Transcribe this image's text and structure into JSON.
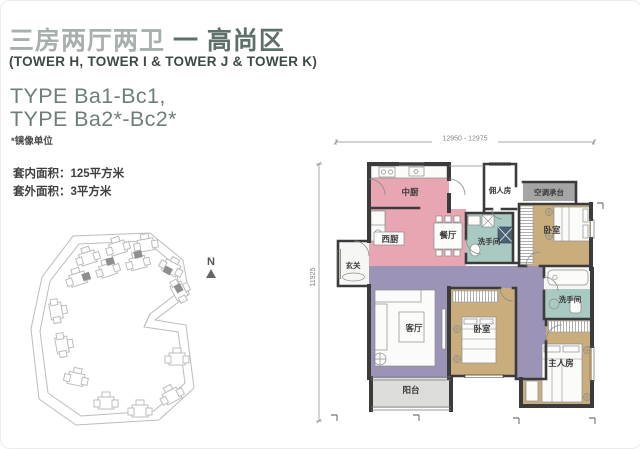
{
  "header": {
    "title_light": "三房两厅两卫",
    "title_bold": "一 高尚区",
    "towers": "(TOWER H, TOWER I & TOWER J & TOWER K)",
    "type_line1": "TYPE Ba1-Bc1,",
    "type_line2": "TYPE Ba2*-Bc2*",
    "mirror_note": "*镜像单位"
  },
  "areas": {
    "inner_area": "套内面积：125平方米",
    "outer_area": "套外面积：3平方米"
  },
  "site_plan": {
    "north_label": "N"
  },
  "floor_plan": {
    "dim_top": "12950 - 12975",
    "dim_left": "11925",
    "rooms": [
      {
        "id": "center-kitchen",
        "label": "中厨"
      },
      {
        "id": "maid-room",
        "label": "佣人房"
      },
      {
        "id": "ac-platform",
        "label": "空调承台"
      },
      {
        "id": "west-kitchen",
        "label": "西厨"
      },
      {
        "id": "dining-room",
        "label": "餐厅"
      },
      {
        "id": "guest-bathroom",
        "label": "洗手间"
      },
      {
        "id": "bedroom-top",
        "label": "卧室"
      },
      {
        "id": "foyer",
        "label": "玄关"
      },
      {
        "id": "living-room",
        "label": "客厅"
      },
      {
        "id": "bedroom-middle",
        "label": "卧室"
      },
      {
        "id": "master-bathroom",
        "label": "洗手间"
      },
      {
        "id": "master-bedroom",
        "label": "主人房"
      },
      {
        "id": "balcony",
        "label": "阳台"
      }
    ]
  },
  "colors": {
    "title_light": "#a8b0ad",
    "title_dark": "#5f6f6b",
    "type_text": "#6e7e7b",
    "body_text": "#3f3f3f",
    "kitchen_pink": "#e7a6b2",
    "living_purple": "#9b94b6",
    "bedroom_tan": "#c9ad7d",
    "bath_teal": "#a9cac3",
    "shower_dark": "#4a6273",
    "platform_gray": "#a5a5a5",
    "floor_gray": "#dcdcda",
    "wall": "#3b3b3b"
  }
}
